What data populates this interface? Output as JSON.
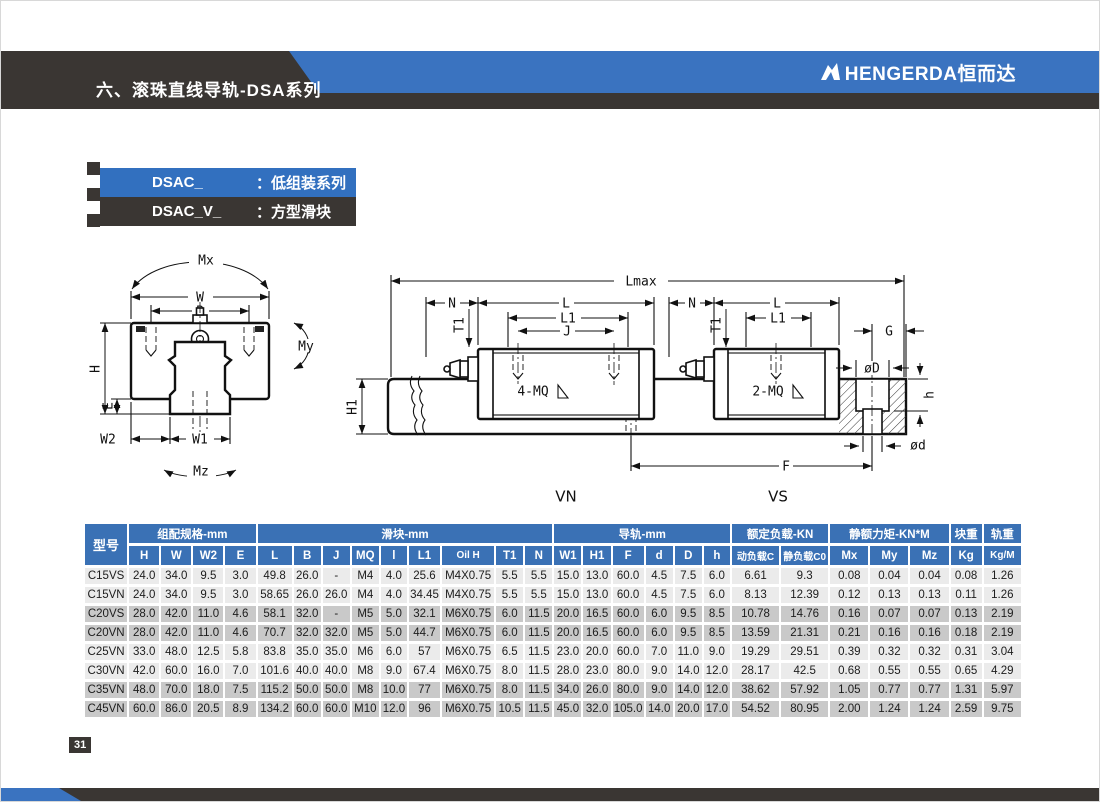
{
  "header": {
    "title": "六、滚珠直线导轨-DSA系列",
    "brand": "HENGERDA恒而达"
  },
  "series_tags": [
    {
      "code": "DSAC_",
      "sep": "：",
      "desc": "低组装系列"
    },
    {
      "code": "DSAC_V_",
      "sep": "：",
      "desc": "方型滑块"
    }
  ],
  "colors": {
    "accent_blue": "#3a73c0",
    "tag_blue": "#3270bf",
    "dark_band": "#3a3633",
    "table_header_blue": "#3a71b5",
    "row_light": "#ebebeb",
    "row_dark": "#c9c9c9"
  },
  "diagram": {
    "cross_section": {
      "mx": "Mx",
      "w": "W",
      "b": "B",
      "h_dim": "H",
      "e": "E",
      "w2": "W2",
      "w1": "W1",
      "my": "My",
      "mz": "Mz"
    },
    "side_view": {
      "lmax": "Lmax",
      "n_left": "N",
      "l_left": "L",
      "l1_left": "L1",
      "j": "J",
      "t1_left": "T1",
      "h1": "H1",
      "mq4": "4-MQ",
      "n_right": "N",
      "t1_right": "T1",
      "l_right": "L",
      "l1_right": "L1",
      "mq2": "2-MQ",
      "g": "G",
      "dia_D": "øD",
      "h_small": "h",
      "dia_d": "ød",
      "f": "F",
      "vn": "VN",
      "vs": "VS"
    }
  },
  "table": {
    "model_header": "型号",
    "groups": [
      {
        "label": "组配规格-mm",
        "span": 4
      },
      {
        "label": "滑块-mm",
        "span": 9
      },
      {
        "label": "导轨-mm",
        "span": 6
      },
      {
        "label": "额定负载-KN",
        "span": 2
      },
      {
        "label": "静额力矩-KN*M",
        "span": 3
      },
      {
        "label": "块重",
        "span": 1
      },
      {
        "label": "轨重",
        "span": 1
      }
    ],
    "subheaders": [
      "H",
      "W",
      "W2",
      "E",
      "L",
      "B",
      "J",
      "MQ",
      "l",
      "L1",
      "Oil H",
      "T1",
      "N",
      "W1",
      "H1",
      "F",
      "d",
      "D",
      "h",
      "动负载C",
      "静负载C0",
      "Mx",
      "My",
      "Mz",
      "Kg",
      "Kg/M"
    ],
    "rows": [
      {
        "model": "C15VS",
        "shade": "light",
        "values": [
          "24.0",
          "34.0",
          "9.5",
          "3.0",
          "49.8",
          "26.0",
          "-",
          "M4",
          "4.0",
          "25.6",
          "M4X0.75",
          "5.5",
          "5.5",
          "15.0",
          "13.0",
          "60.0",
          "4.5",
          "7.5",
          "6.0",
          "6.61",
          "9.3",
          "0.08",
          "0.04",
          "0.04",
          "0.08",
          "1.26"
        ]
      },
      {
        "model": "C15VN",
        "shade": "light",
        "values": [
          "24.0",
          "34.0",
          "9.5",
          "3.0",
          "58.65",
          "26.0",
          "26.0",
          "M4",
          "4.0",
          "34.45",
          "M4X0.75",
          "5.5",
          "5.5",
          "15.0",
          "13.0",
          "60.0",
          "4.5",
          "7.5",
          "6.0",
          "8.13",
          "12.39",
          "0.12",
          "0.13",
          "0.13",
          "0.11",
          "1.26"
        ]
      },
      {
        "model": "C20VS",
        "shade": "dark",
        "values": [
          "28.0",
          "42.0",
          "11.0",
          "4.6",
          "58.1",
          "32.0",
          "-",
          "M5",
          "5.0",
          "32.1",
          "M6X0.75",
          "6.0",
          "11.5",
          "20.0",
          "16.5",
          "60.0",
          "6.0",
          "9.5",
          "8.5",
          "10.78",
          "14.76",
          "0.16",
          "0.07",
          "0.07",
          "0.13",
          "2.19"
        ]
      },
      {
        "model": "C20VN",
        "shade": "dark",
        "values": [
          "28.0",
          "42.0",
          "11.0",
          "4.6",
          "70.7",
          "32.0",
          "32.0",
          "M5",
          "5.0",
          "44.7",
          "M6X0.75",
          "6.0",
          "11.5",
          "20.0",
          "16.5",
          "60.0",
          "6.0",
          "9.5",
          "8.5",
          "13.59",
          "21.31",
          "0.21",
          "0.16",
          "0.16",
          "0.18",
          "2.19"
        ]
      },
      {
        "model": "C25VN",
        "shade": "light",
        "values": [
          "33.0",
          "48.0",
          "12.5",
          "5.8",
          "83.8",
          "35.0",
          "35.0",
          "M6",
          "6.0",
          "57",
          "M6X0.75",
          "6.5",
          "11.5",
          "23.0",
          "20.0",
          "60.0",
          "7.0",
          "11.0",
          "9.0",
          "19.29",
          "29.51",
          "0.39",
          "0.32",
          "0.32",
          "0.31",
          "3.04"
        ]
      },
      {
        "model": "C30VN",
        "shade": "light",
        "values": [
          "42.0",
          "60.0",
          "16.0",
          "7.0",
          "101.6",
          "40.0",
          "40.0",
          "M8",
          "9.0",
          "67.4",
          "M6X0.75",
          "8.0",
          "11.5",
          "28.0",
          "23.0",
          "80.0",
          "9.0",
          "14.0",
          "12.0",
          "28.17",
          "42.5",
          "0.68",
          "0.55",
          "0.55",
          "0.65",
          "4.29"
        ]
      },
      {
        "model": "C35VN",
        "shade": "dark",
        "values": [
          "48.0",
          "70.0",
          "18.0",
          "7.5",
          "115.2",
          "50.0",
          "50.0",
          "M8",
          "10.0",
          "77",
          "M6X0.75",
          "8.0",
          "11.5",
          "34.0",
          "26.0",
          "80.0",
          "9.0",
          "14.0",
          "12.0",
          "38.62",
          "57.92",
          "1.05",
          "0.77",
          "0.77",
          "1.31",
          "5.97"
        ]
      },
      {
        "model": "C45VN",
        "shade": "dark",
        "values": [
          "60.0",
          "86.0",
          "20.5",
          "8.9",
          "134.2",
          "60.0",
          "60.0",
          "M10",
          "12.0",
          "96",
          "M6X0.75",
          "10.5",
          "11.5",
          "45.0",
          "32.0",
          "105.0",
          "14.0",
          "20.0",
          "17.0",
          "54.52",
          "80.95",
          "2.00",
          "1.24",
          "1.24",
          "2.59",
          "9.75"
        ]
      }
    ]
  },
  "footer": {
    "page_number": "31"
  }
}
